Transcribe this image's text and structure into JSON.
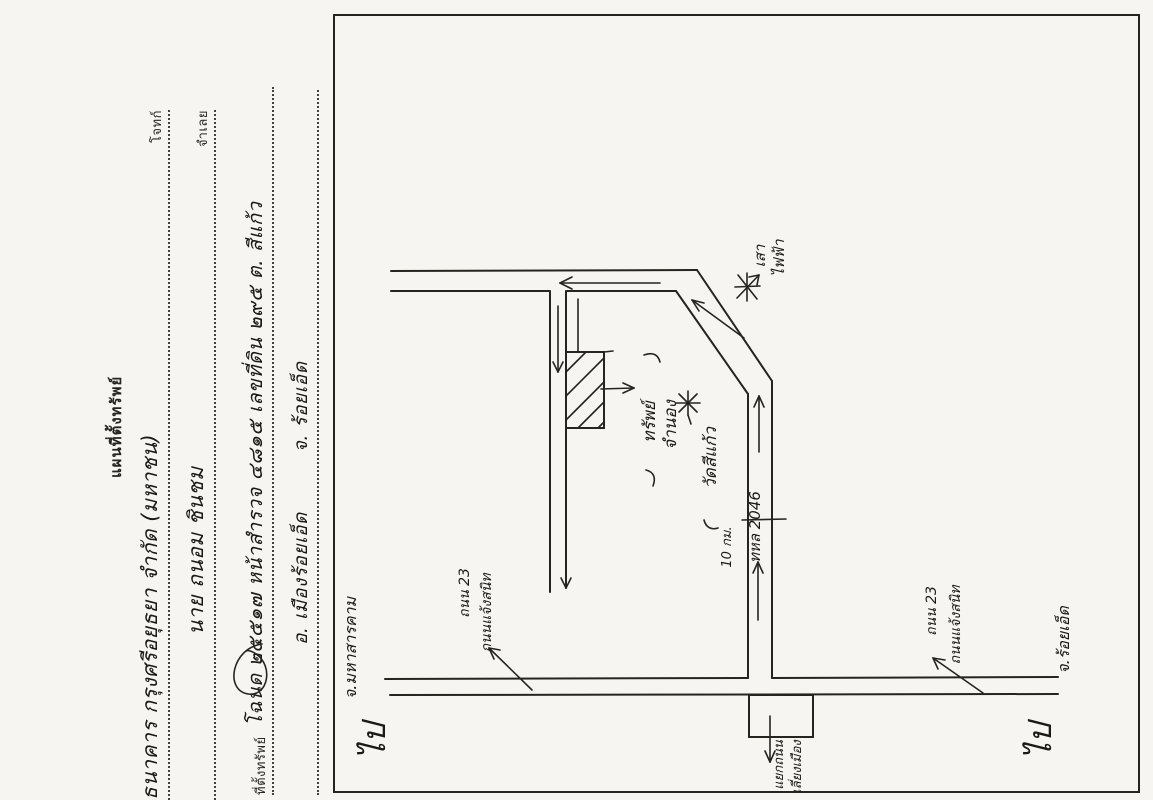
{
  "document": {
    "title": "แผนที่ตั้งทรัพย์",
    "fields": [
      {
        "label": "โจทก์",
        "value": "ธนาคาร กรุงศรีอยุธยา จำกัด (มหาชน)"
      },
      {
        "label": "จำเลย",
        "value": "นาย ถนอม ชินชม"
      },
      {
        "label": "ที่ตั้งทรัพย์",
        "value": "โฉนด ๒๕๕๑๗ หน้าสำรวจ ๔๘๑๕ เลขที่ดิน ๒๙๕ ต. สีแก้ว"
      },
      {
        "label": "",
        "value": "อ. เมืองร้อยเอ็ด",
        "value2": "จ. ร้อยเอ็ด"
      }
    ]
  },
  "map": {
    "labels": {
      "property_line1": "ทรัพย์",
      "property_line2": "จำนอง",
      "temple": "วัดสีแก้ว",
      "pole_line1": "เสา",
      "pole_line2": "ไฟฟ้า",
      "highway": "ทหล 2046",
      "km_marker": "10 กม.",
      "left_sign_line1": "ถนน 23",
      "left_sign_line2": "ถนนแจ้งสนิท",
      "right_sign_line1": "ถนน 23",
      "right_sign_line2": "ถนนแจ้งสนิท",
      "junction_line1": "แยกถนน",
      "junction_line2": "เลี่ยงเมือง",
      "dest_west_prefix": "ไป",
      "dest_west": "จ.มหาสารคาม",
      "dest_east_prefix": "ไป",
      "dest_east": "จ.ร้อยเอ็ด"
    },
    "colors": {
      "paper": "#f6f5f1",
      "ink": "#26241f"
    }
  }
}
